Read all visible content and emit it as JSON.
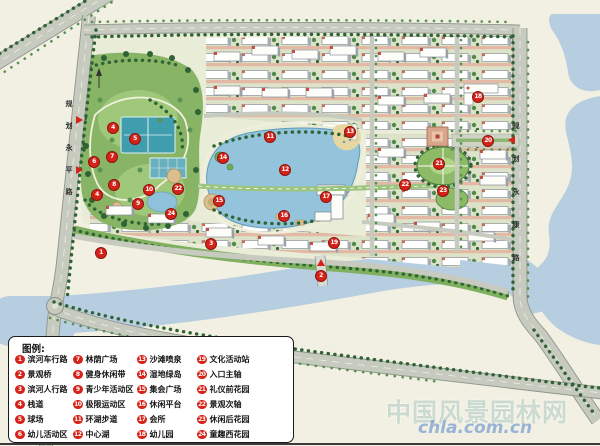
{
  "legend": {
    "title": "图例:",
    "items": [
      {
        "n": "1",
        "label": "滨河车行路"
      },
      {
        "n": "2",
        "label": "景观桥"
      },
      {
        "n": "3",
        "label": "滨河人行路"
      },
      {
        "n": "4",
        "label": "栈道"
      },
      {
        "n": "5",
        "label": "球场"
      },
      {
        "n": "6",
        "label": "幼儿活动区"
      },
      {
        "n": "7",
        "label": "林荫广场"
      },
      {
        "n": "8",
        "label": "健身休闲带"
      },
      {
        "n": "9",
        "label": "青少年活动区"
      },
      {
        "n": "10",
        "label": "极限运动区"
      },
      {
        "n": "11",
        "label": "环湖步道"
      },
      {
        "n": "12",
        "label": "中心湖"
      },
      {
        "n": "13",
        "label": "沙滩喷泉"
      },
      {
        "n": "14",
        "label": "湿地绿岛"
      },
      {
        "n": "15",
        "label": "集会广场"
      },
      {
        "n": "16",
        "label": "休闲平台"
      },
      {
        "n": "17",
        "label": "会所"
      },
      {
        "n": "18",
        "label": "幼儿园"
      },
      {
        "n": "19",
        "label": "文化活动站"
      },
      {
        "n": "20",
        "label": "入口主轴"
      },
      {
        "n": "21",
        "label": "礼仪前花园"
      },
      {
        "n": "22",
        "label": "景观次轴"
      },
      {
        "n": "23",
        "label": "休闲后花园"
      },
      {
        "n": "24",
        "label": "童趣西花园"
      }
    ]
  },
  "map": {
    "markers": [
      {
        "n": "1",
        "x": 100,
        "y": 252
      },
      {
        "n": "2",
        "x": 320,
        "y": 275
      },
      {
        "n": "3",
        "x": 210,
        "y": 243
      },
      {
        "n": "4",
        "x": 112,
        "y": 127
      },
      {
        "n": "4",
        "x": 96,
        "y": 194
      },
      {
        "n": "5",
        "x": 134,
        "y": 138
      },
      {
        "n": "6",
        "x": 93,
        "y": 161
      },
      {
        "n": "7",
        "x": 111,
        "y": 156
      },
      {
        "n": "8",
        "x": 113,
        "y": 184
      },
      {
        "n": "9",
        "x": 137,
        "y": 203
      },
      {
        "n": "10",
        "x": 148,
        "y": 189
      },
      {
        "n": "11",
        "x": 269,
        "y": 136
      },
      {
        "n": "12",
        "x": 284,
        "y": 169
      },
      {
        "n": "13",
        "x": 349,
        "y": 131
      },
      {
        "n": "14",
        "x": 222,
        "y": 157
      },
      {
        "n": "15",
        "x": 218,
        "y": 200
      },
      {
        "n": "16",
        "x": 283,
        "y": 215
      },
      {
        "n": "17",
        "x": 325,
        "y": 196
      },
      {
        "n": "18",
        "x": 477,
        "y": 96
      },
      {
        "n": "19",
        "x": 333,
        "y": 242
      },
      {
        "n": "20",
        "x": 487,
        "y": 140
      },
      {
        "n": "21",
        "x": 438,
        "y": 163
      },
      {
        "n": "22",
        "x": 404,
        "y": 184
      },
      {
        "n": "22",
        "x": 177,
        "y": 188
      },
      {
        "n": "23",
        "x": 442,
        "y": 190
      },
      {
        "n": "24",
        "x": 170,
        "y": 213
      }
    ],
    "road_labels": [
      {
        "name": "left-road",
        "text": "规划永平路",
        "x": 69,
        "y": 99,
        "dy": 22
      },
      {
        "name": "right-road",
        "text": "规划永康路",
        "x": 516,
        "y": 121,
        "dy": 33
      }
    ]
  },
  "watermark": {
    "site_name": "中国风景园林网",
    "url": "chla.com.cn"
  },
  "colors": {
    "marker_red": "#d6231a",
    "river_water": "#b7cde0",
    "lake_water": "#93c4dc",
    "park_green": "#88b465"
  }
}
